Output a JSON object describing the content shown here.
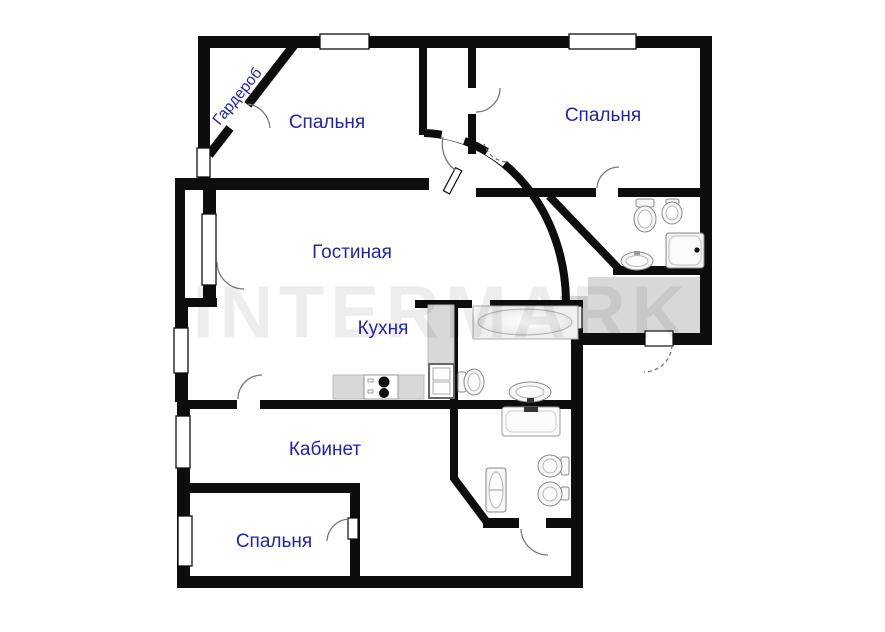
{
  "watermark": {
    "text": "INTERMARK"
  },
  "rooms": [
    {
      "id": "wardrobe",
      "label": "Гардероб"
    },
    {
      "id": "bedroom-top-left",
      "label": "Спальня"
    },
    {
      "id": "bedroom-top-right",
      "label": "Спальня"
    },
    {
      "id": "living-room",
      "label": "Гостиная"
    },
    {
      "id": "kitchen",
      "label": "Кухня"
    },
    {
      "id": "office",
      "label": "Кабинет"
    },
    {
      "id": "bedroom-bottom",
      "label": "Спальня"
    }
  ],
  "colors": {
    "wall": "#0d0d0d",
    "label": "#2222aa",
    "floor_shade": "#d8d8d8",
    "watermark": "rgba(0,0,0,0.07)"
  },
  "fixtures": [
    "bathtub",
    "shower-cabin",
    "toilet",
    "bidet",
    "washbasin",
    "stove",
    "kitchen-sink",
    "kitchen-counter",
    "washing-machine"
  ]
}
